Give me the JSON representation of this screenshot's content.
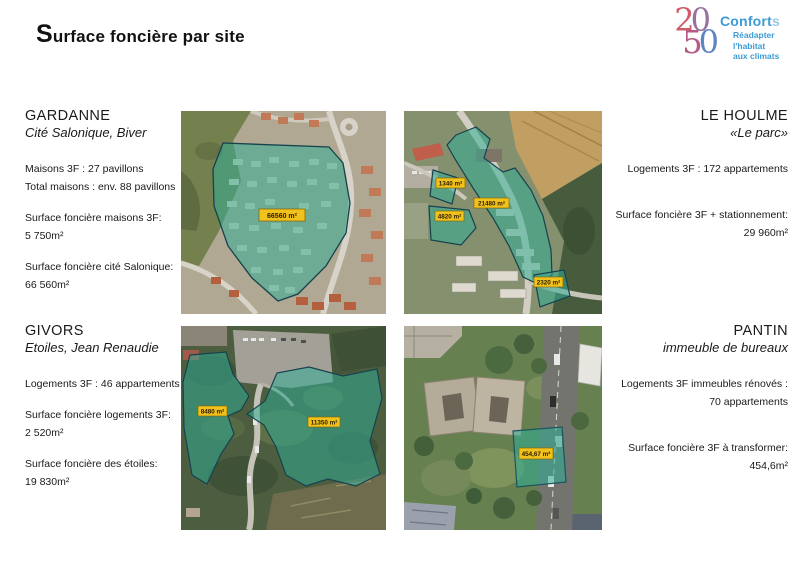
{
  "page": {
    "title_initial": "S",
    "title_rest": "urface foncière par site"
  },
  "logo": {
    "digit_2": "2",
    "digit_0a": "0",
    "digit_5": "5",
    "digit_0b": "0",
    "brand_main": "Confort",
    "brand_s": "s",
    "tagline_line1": "Réadapter",
    "tagline_line2": "l'habitat",
    "tagline_line3": "aux climats"
  },
  "colors": {
    "overlay_teal": "#2fae98",
    "label_yellow": "#f1c11c",
    "brand_blue": "#3d9bd6"
  },
  "sites": [
    {
      "name": "GARDANNE",
      "subtitle": "Cité Salonique, Biver",
      "paragraphs": [
        [
          "Maisons 3F : 27 pavillons",
          "Total maisons : env. 88 pavillons"
        ],
        [
          "Surface foncière maisons 3F:",
          "5 750m²"
        ],
        [
          "Surface foncière cité Salonique:",
          "66 560m²"
        ]
      ],
      "map_labels": [
        "66560 m²"
      ]
    },
    {
      "name": "LE HOULME",
      "subtitle": "«Le parc»",
      "paragraphs": [
        [
          "Logements 3F : 172 appartements"
        ],
        [
          "Surface foncière 3F + stationnement:",
          "29 960m²"
        ]
      ],
      "map_labels": [
        "1340 m²",
        "21480 m²",
        "4820 m²",
        "2320 m²"
      ]
    },
    {
      "name": "GIVORS",
      "subtitle": "Etoiles, Jean Renaudie",
      "paragraphs": [
        [
          "Logements 3F : 46 appartements"
        ],
        [
          "Surface foncière logements 3F:",
          "2 520m²"
        ],
        [
          "Surface foncière des étoiles:",
          "19 830m²"
        ]
      ],
      "map_labels": [
        "8480 m²",
        "11350 m²"
      ]
    },
    {
      "name": "PANTIN",
      "subtitle": "immeuble de bureaux",
      "paragraphs": [
        [
          "Logements 3F immeubles rénovés :",
          "70 appartements"
        ],
        [
          "Surface foncière 3F à transformer:",
          "454,6m²"
        ]
      ],
      "map_labels": [
        "454,67 m²"
      ]
    }
  ]
}
